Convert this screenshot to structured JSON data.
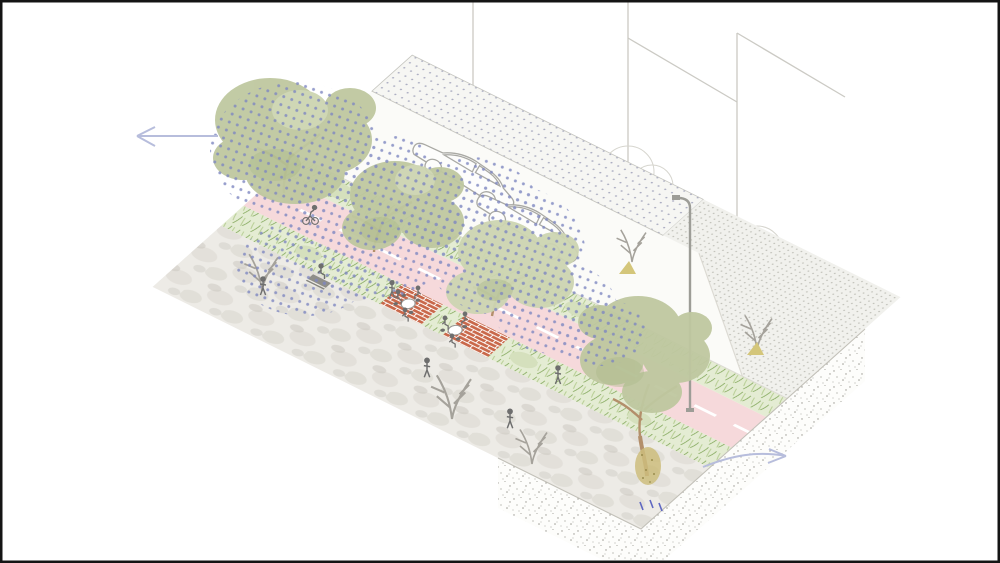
{
  "illustration": {
    "kind": "axonometric-street-design-rendering",
    "elements": [
      "front-sidewalk",
      "planting-strip-with-seating",
      "brick-seating-patches",
      "two-way-bike-lane",
      "second-planting-strip",
      "roadway",
      "angled-parking-pad",
      "rear-sidewalk",
      "soil-cross-section",
      "street-trees",
      "canopy-dot-overlay",
      "parked-cars",
      "pedestrians",
      "cyclist",
      "cafe-tables",
      "bench",
      "street-lamp",
      "direction-arrows",
      "building-outline-lines",
      "background-trees"
    ],
    "counts": {
      "street_trees": 4,
      "bare_trees": 5,
      "parked_cars": 2,
      "pedestrians_walking": 5,
      "people_seated": 7,
      "cyclists": 1,
      "cafe_tables": 2,
      "benches": 1,
      "street_lamps": 1,
      "direction_arrows": 2,
      "brick_patches": 2
    }
  },
  "colors": {
    "background": "#ffffff",
    "frame": "#141414",
    "sidewalk_base": "#edebe6",
    "sidewalk_mottle": "#d7d4cc",
    "sidewalk_mottle2": "#c9c6be",
    "planting_base": "#e4ecd3",
    "grass_blade": "#85a95e",
    "grass_blade_light": "#b3cb8e",
    "shrub": "#d5e0bd",
    "bike_lane": "#f6d9db",
    "lane_dash": "#ffffff",
    "road": "#fbfbf8",
    "curb": "#dcdad3",
    "parking_base": "#f6f6f3",
    "parking_dot": "#a9abc0",
    "parking_border": "#c6c6c0",
    "rear_walk_base": "#f1f1ed",
    "rear_walk_dot": "#bdbdb5",
    "brick": "#c9684a",
    "brick_joint": "#ffffff",
    "canopy_green": "#bfc8a0",
    "canopy_green_light": "#cdd5b2",
    "canopy_accent": "#a9b787",
    "canopy_dots": "#7e87c1",
    "trunk": "#b38f6b",
    "bare_branch": "#a5a29b",
    "outline_tree": "#d6d5ce",
    "leaf_pile": "#d4c67a",
    "soil_face": "#fdfdfb",
    "soil_speck": "#97968f",
    "soil_edge": "#c2c0b8",
    "root_ball": "#cdbd7d",
    "root_speck": "#9a8d4f",
    "water_drop": "#5f68c2",
    "car_outline": "#a9a9a4",
    "car_fill": "#fdfdfc",
    "person": "#6e6e6e",
    "bench": "#85857f",
    "table_stroke": "#9a9a96",
    "lamp": "#9d9d97",
    "building_line": "#cbcac4",
    "arrow": "#b7bddc"
  }
}
